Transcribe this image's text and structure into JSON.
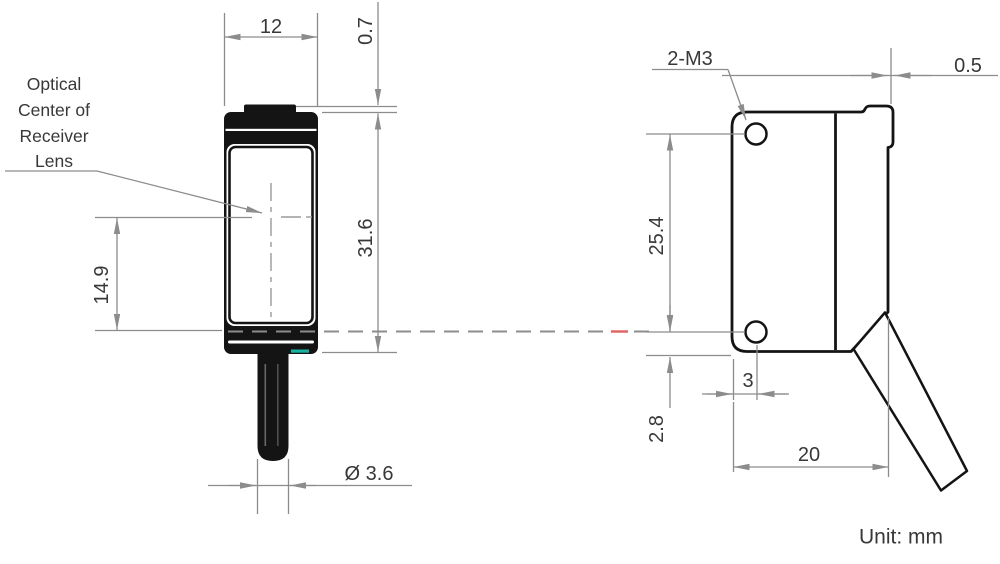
{
  "drawing": {
    "title": "photoelectric-sensor-dimension-drawing",
    "unit_label": "Unit: mm",
    "front_view": {
      "optical_label": {
        "line1": "Optical",
        "line2": "Center of",
        "line3": "Receiver",
        "line4": "Lens"
      },
      "width_dim": "12",
      "lens_offset_dim": "0.7",
      "height_dim": "31.6",
      "optical_center_dim": "14.9",
      "cable_diameter_dim": "Ø 3.6"
    },
    "side_view": {
      "mounting_hole_dim": "2-M3",
      "hole_pitch_dim": "25.4",
      "bottom_edge_dim": "2.8",
      "hole_inset_dim": "3",
      "depth_dim": "20",
      "lens_protrusion_dim": "0.5"
    },
    "colors": {
      "outline_black": "#141414",
      "dimension_gray": "#8c8c8c",
      "beam_accent_red": "#e06666",
      "led_indicator_teal": "#17b3a0"
    }
  }
}
